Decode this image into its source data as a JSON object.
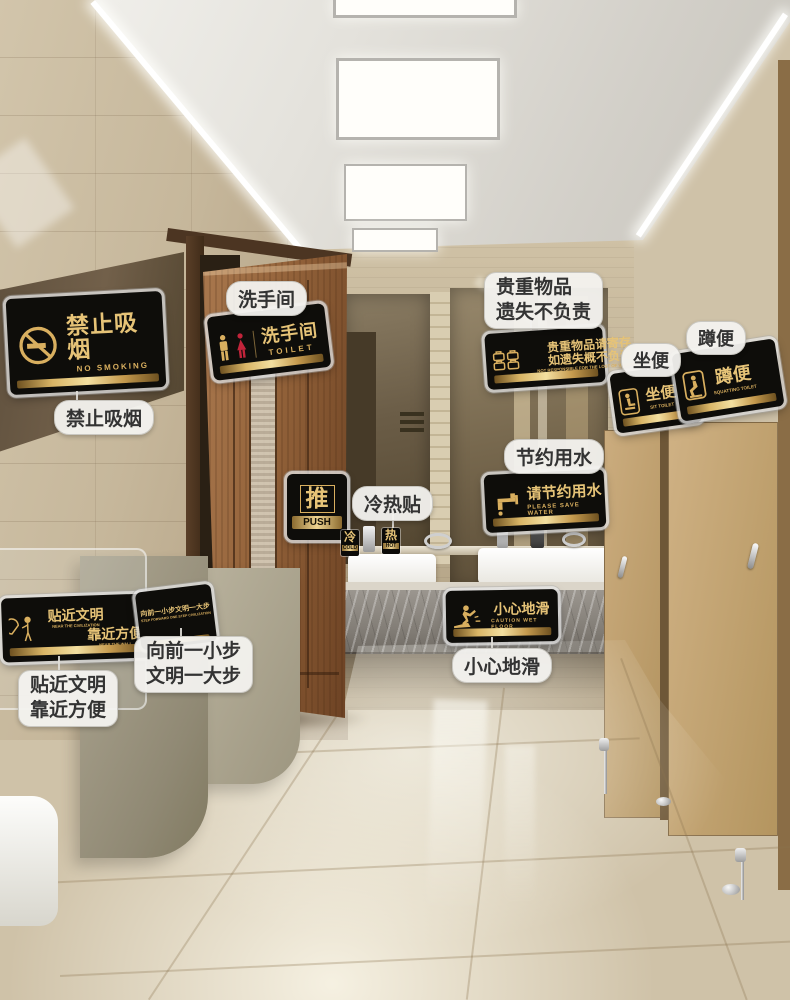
{
  "colors": {
    "sign_black": "#0e0d0a",
    "sign_gold": "#d9af5f",
    "sign_gold_bright": "#e6c377",
    "female_red": "#c2243a",
    "bubble_bg": "#f3f2ef",
    "wood_door": "#96653c",
    "wall_tile": "#c6b79b"
  },
  "signs": {
    "no_smoking": {
      "cn": "禁止吸烟",
      "en": "NO SMOKING",
      "label": "禁止吸烟"
    },
    "toilet": {
      "cn": "洗手间",
      "en": "TOILET",
      "label": "洗手间"
    },
    "push": {
      "cn": "推",
      "en": "PUSH"
    },
    "hot_cold": {
      "label": "冷热贴",
      "cold": "冷",
      "cold_en": "COLD",
      "hot": "热",
      "hot_en": "HOT"
    },
    "valuables": {
      "cn_line1": "贵重物品请寄存",
      "cn_line2": "如遗失概不负责",
      "en": "NOT RESPONSIBLE FOR THE LOST OF VALUABLES",
      "label_line1": "贵重物品",
      "label_line2": "遗失不负责"
    },
    "save_water": {
      "cn": "请节约用水",
      "en": "PLEASE SAVE WATER",
      "label": "节约用水"
    },
    "sit_toilet": {
      "cn": "坐便",
      "en": "SIT TOILET",
      "label": "坐便"
    },
    "squat_toilet": {
      "cn": "蹲便",
      "en": "SQUATTING TOILET",
      "label": "蹲便"
    },
    "wet_floor": {
      "cn": "小心地滑",
      "en": "CAUTION WET FLOOR",
      "label": "小心地滑"
    },
    "civilization": {
      "cn_line1": "贴近文明",
      "en_line1": "NEAR THE CIVILIZATION",
      "cn_line2": "靠近方便",
      "en_line2": "NEAR THE WALL",
      "label_line1": "贴近文明",
      "label_line2": "靠近方便"
    },
    "step_forward": {
      "cn": "向前一小步文明一大步",
      "en": "STEP FORWARD ONE STEP CIVILIZATION",
      "label_line1": "向前一小步",
      "label_line2": "文明一大步"
    }
  }
}
